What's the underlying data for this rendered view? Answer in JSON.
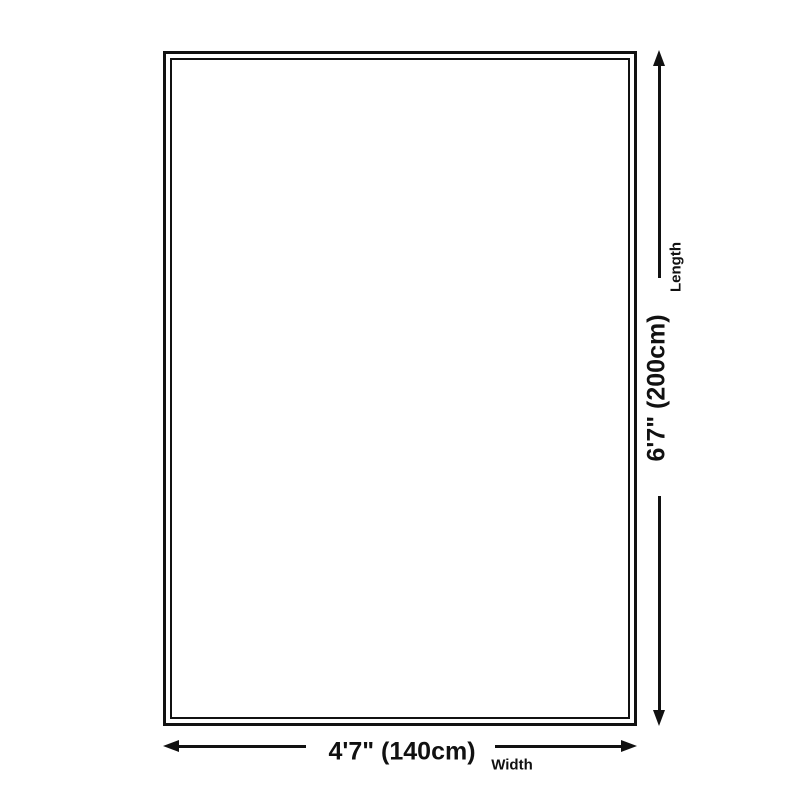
{
  "diagram": {
    "type": "product-dimension-diagram",
    "shape": "rectangle",
    "background_color": "#ffffff",
    "line_color": "#111111",
    "length": {
      "value": "6'7\" (200cm)",
      "label": "Length"
    },
    "width": {
      "value": "4'7\" (140cm)",
      "label": "Width"
    }
  }
}
